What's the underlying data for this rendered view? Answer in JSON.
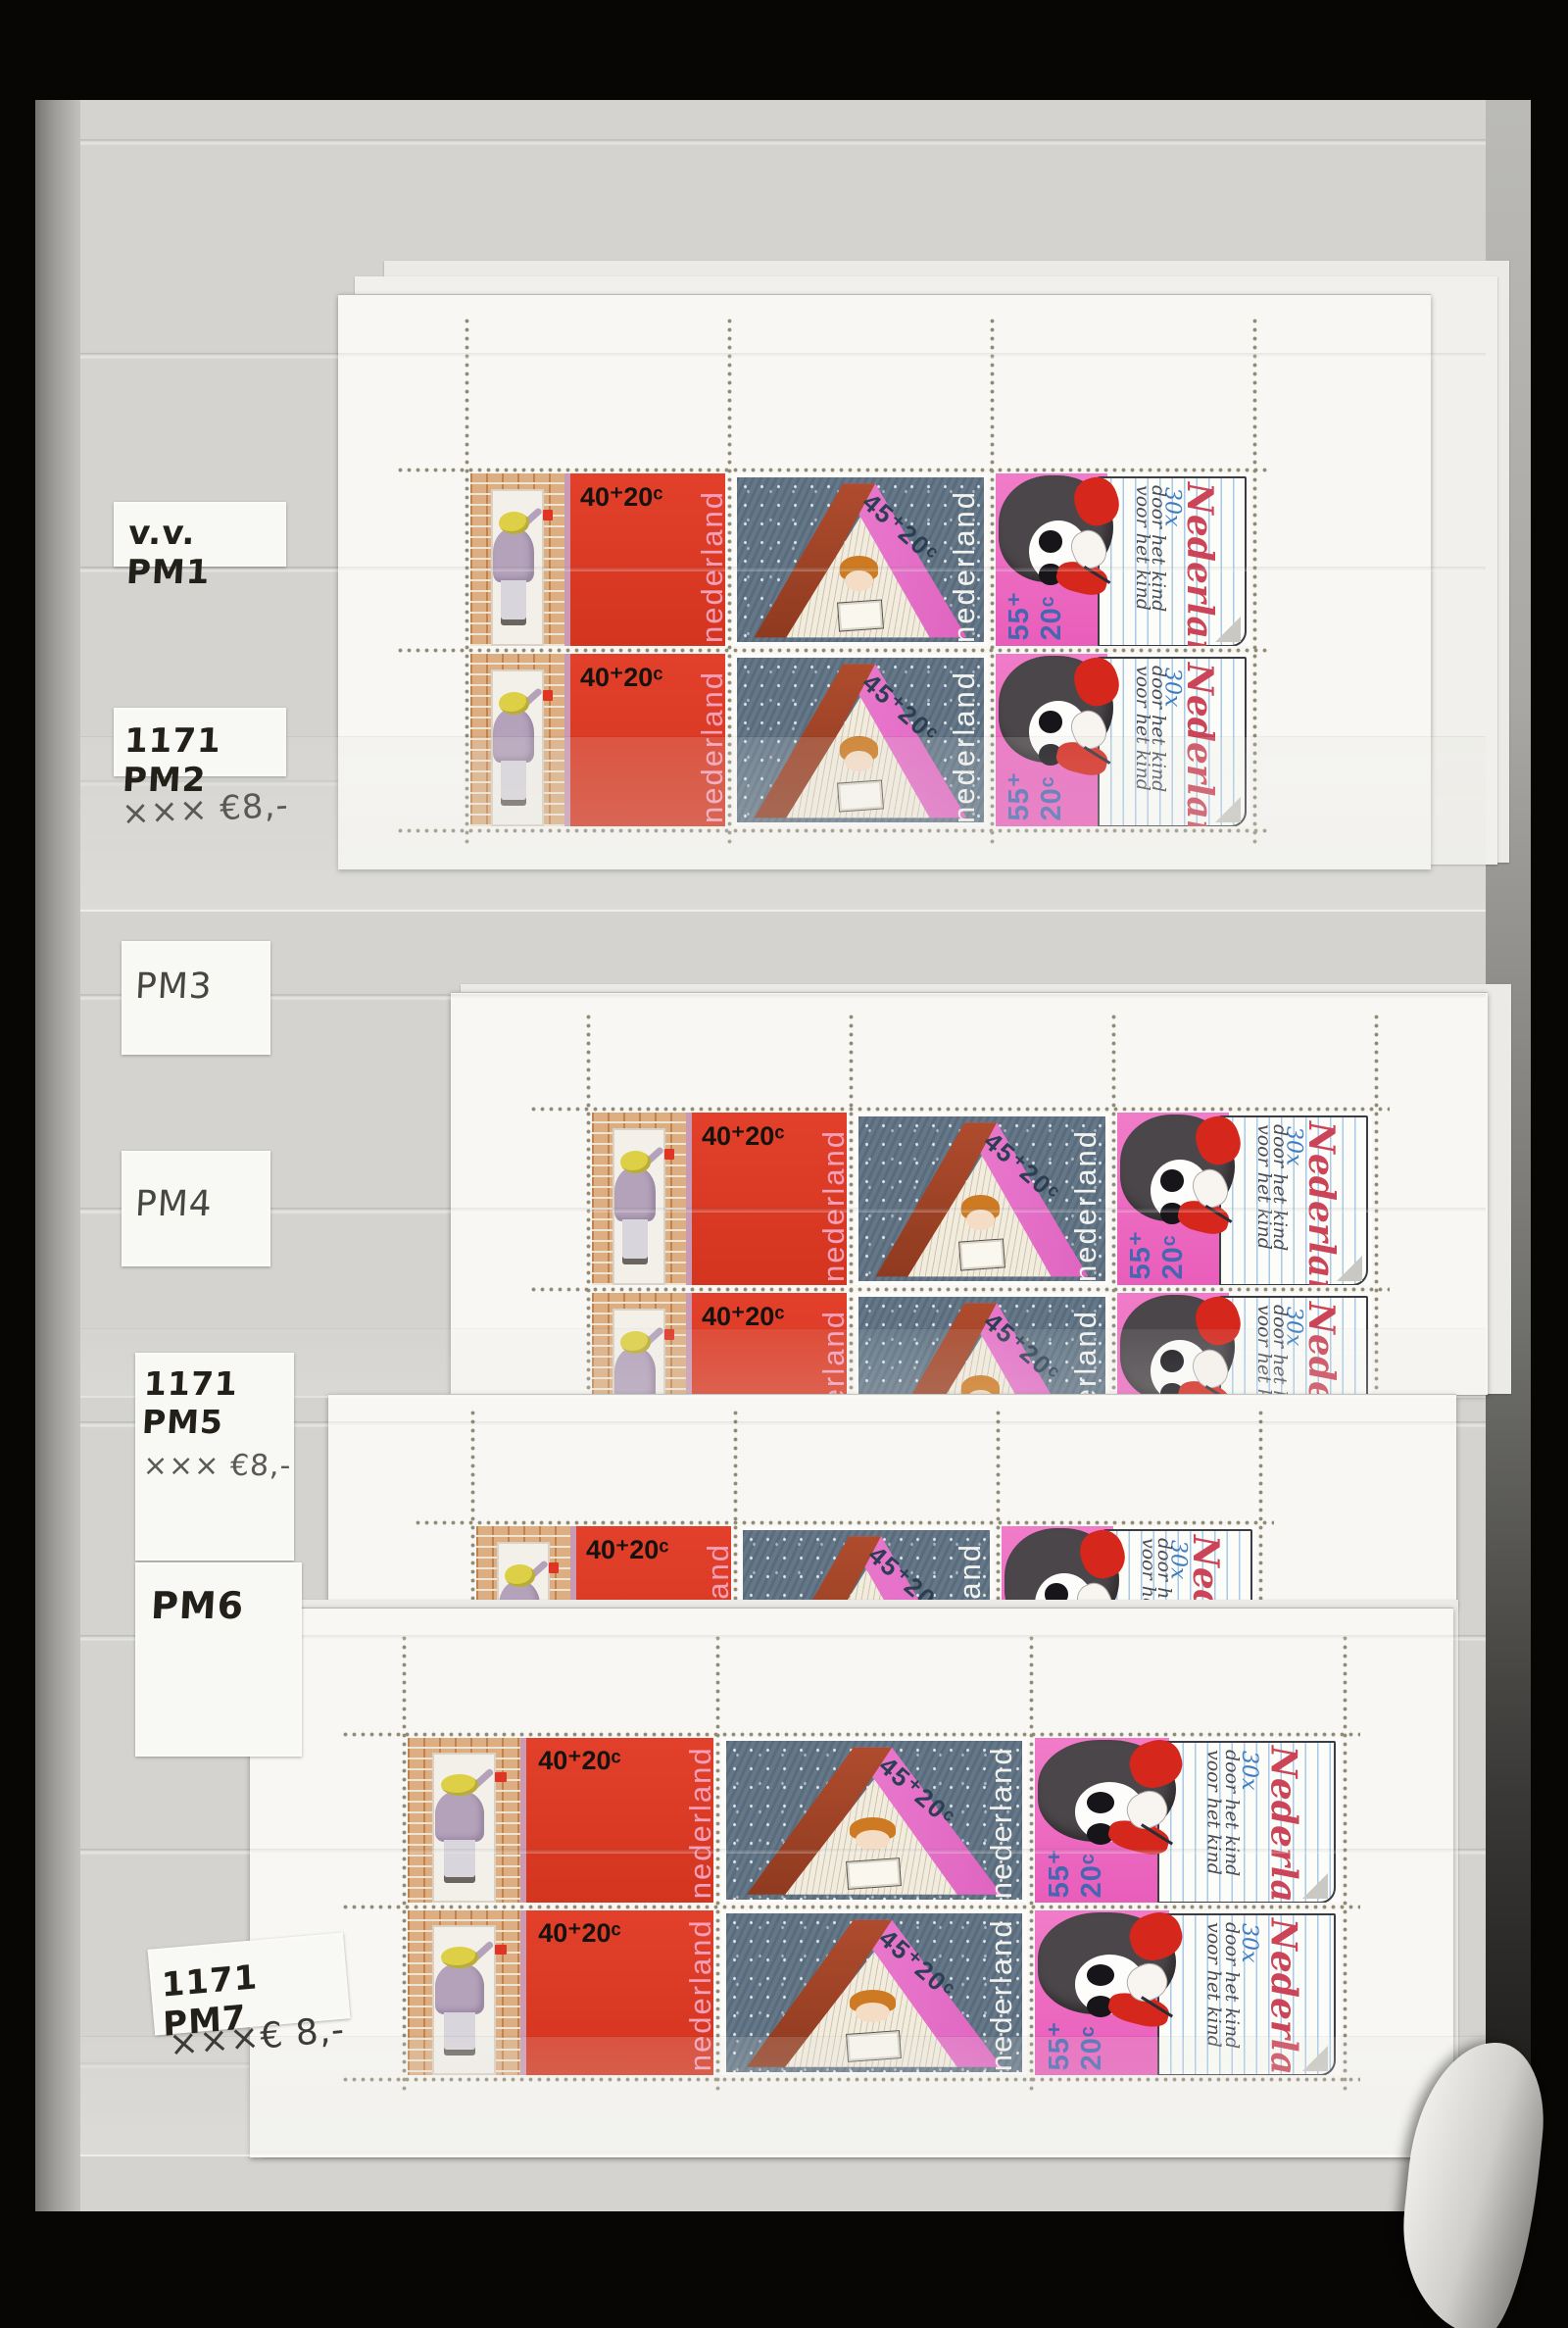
{
  "labels": {
    "pm1": {
      "text": "v.v. PM1"
    },
    "pm2": {
      "text": "1171 PM2"
    },
    "pm2_price": {
      "text": "××× €8,-"
    },
    "pm3": {
      "text": "PM3"
    },
    "pm4": {
      "text": "PM4"
    },
    "pm5": {
      "text": "1171 PM5"
    },
    "pm5_price": {
      "text": "××× €8,-"
    },
    "pm6": {
      "text": "PM6"
    },
    "pm7": {
      "text": "1171 PM7"
    },
    "pm7_price": {
      "text": "×××€ 8,-"
    }
  },
  "stamps": {
    "s40": {
      "denomination": "40⁺20ᶜ",
      "country": "nederland",
      "panel_color": "#de3b26",
      "country_color": "#f5a0ba"
    },
    "s45": {
      "denomination": "45⁺20ᶜ",
      "country": "nederland",
      "bg_color": "#64788a",
      "cover_color": "#a2432a",
      "inner_color": "#e978cd"
    },
    "s55": {
      "denomination_top": "55⁺",
      "denomination_bottom": "20ᶜ",
      "country_script": "Nederland",
      "count": "30x",
      "slogan_1": "door het kind",
      "slogan_2": "voor het kind",
      "pink_color": "#ee6ec6"
    }
  }
}
